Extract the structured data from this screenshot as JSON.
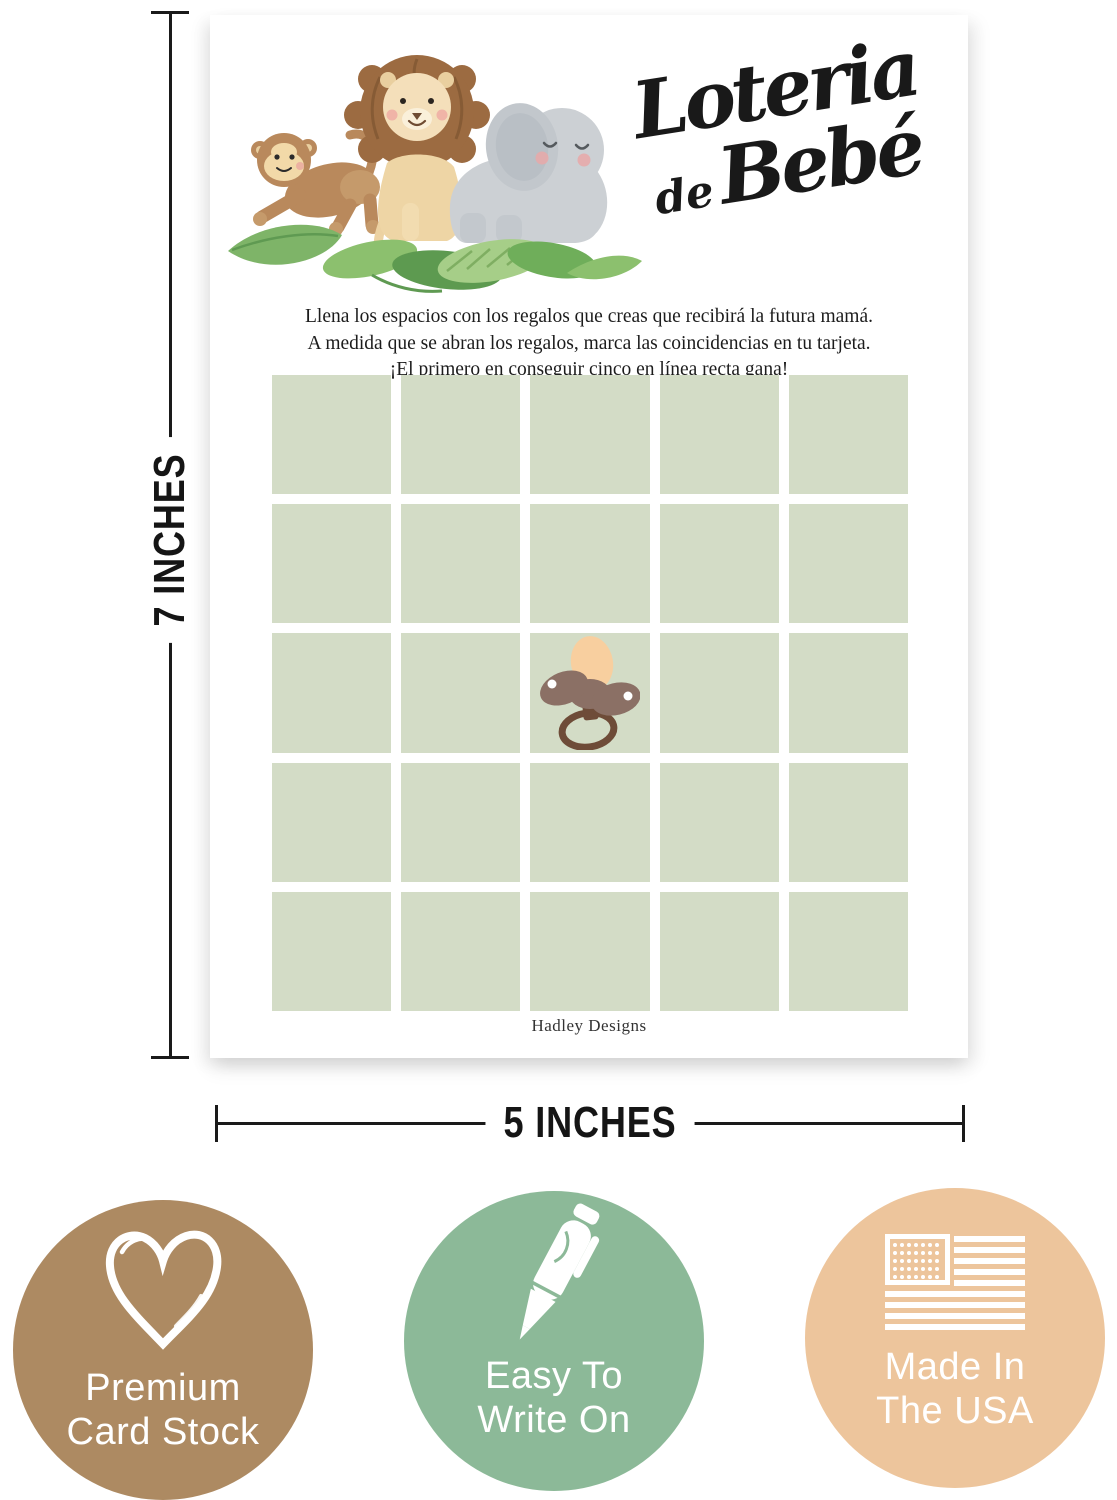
{
  "card": {
    "title_line1": "Loteria",
    "title_de": "de",
    "title_bebe": "Bebé",
    "instructions": [
      "Llena los espacios con los regalos que creas que recibirá la futura mamá.",
      "A medida que se abran los regalos, marca las coincidencias en tu tarjeta.",
      "¡El primero en conseguir cinco en línea recta gana!"
    ],
    "brand": "Hadley Designs",
    "grid": {
      "rows": 5,
      "cols": 5,
      "cell_color": "#d3dcc6",
      "free_space_icon": "pacifier-icon"
    },
    "illustration_icons": [
      "monkey-icon",
      "lion-icon",
      "elephant-icon",
      "leaves-icon"
    ]
  },
  "dimensions": {
    "height_label": "7 INCHES",
    "width_label": "5 INCHES",
    "line_color": "#1a1a1a"
  },
  "badges": [
    {
      "icon": "heart-icon",
      "label_line1": "Premium",
      "label_line2": "Card Stock",
      "color": "#ad8a62"
    },
    {
      "icon": "pen-icon",
      "label_line1": "Easy To",
      "label_line2": "Write On",
      "color": "#8cb998"
    },
    {
      "icon": "us-flag-icon",
      "label_line1": "Made In",
      "label_line2": "The USA",
      "color": "#edc59c"
    }
  ]
}
